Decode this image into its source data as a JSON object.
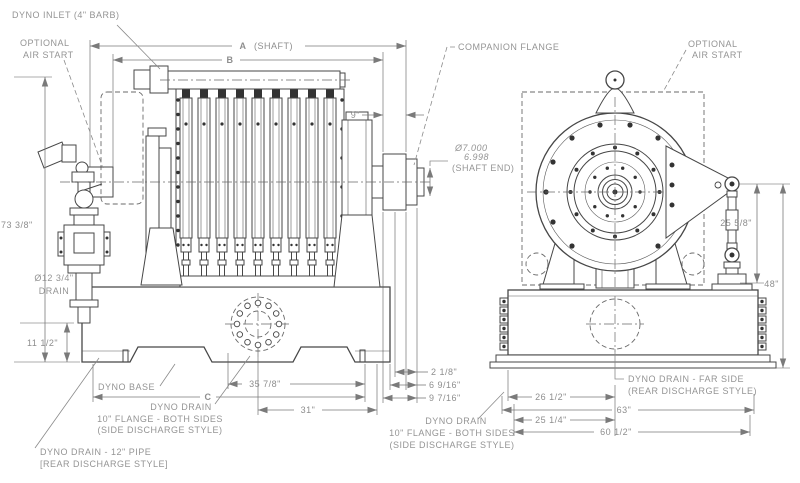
{
  "colors": {
    "background": "#ffffff",
    "line": "#474747",
    "dimension": "#7a7a7a",
    "text": "#949494",
    "dark_fill": "#333333"
  },
  "side": {
    "callouts": {
      "inlet": "DYNO INLET (4\" BARB)",
      "air_start": [
        "OPTIONAL",
        "AIR START"
      ],
      "drain_dia": [
        "Ø12 3/4\"",
        "DRAIN"
      ],
      "base_label": "DYNO BASE",
      "drain_flange": [
        "DYNO DRAIN",
        "10\" FLANGE - BOTH SIDES",
        "(SIDE DISCHARGE STYLE)"
      ],
      "drain_pipe": [
        "DYNO DRAIN - 12\" PIPE",
        "[REAR DISCHARGE STYLE]"
      ]
    },
    "dims": {
      "a": "A",
      "a_note": "(SHAFT)",
      "b": "B",
      "total_height": "73 3/8\"",
      "base_height": "11 1/2\"",
      "shaft_ext": "9\"",
      "d2_1_8": "2 1/8\"",
      "d6_9_16": "6 9/16\"",
      "d9_7_16": "9 7/16\"",
      "d35_7_8": "35 7/8\"",
      "d31": "31\"",
      "c": "C"
    }
  },
  "front": {
    "callouts": {
      "companion": "COMPANION FLANGE",
      "air_start": [
        "OPTIONAL",
        "AIR START"
      ],
      "shaft_end": [
        "Ø7.000",
        "6.998",
        "(SHAFT END)"
      ],
      "drain_far": [
        "DYNO DRAIN - FAR SIDE",
        "(REAR DISCHARGE STYLE)"
      ],
      "drain_flange": [
        "DYNO DRAIN",
        "10\" FLANGE - BOTH SIDES",
        "(SIDE DISCHARGE STYLE)"
      ]
    },
    "dims": {
      "arm": "25 5/8\"",
      "total_height": "48\"",
      "w26_1_2": "26 1/2\"",
      "w63": "63\"",
      "w25_1_4": "25 1/4\"",
      "w60_1_2": "60 1/2\""
    }
  }
}
